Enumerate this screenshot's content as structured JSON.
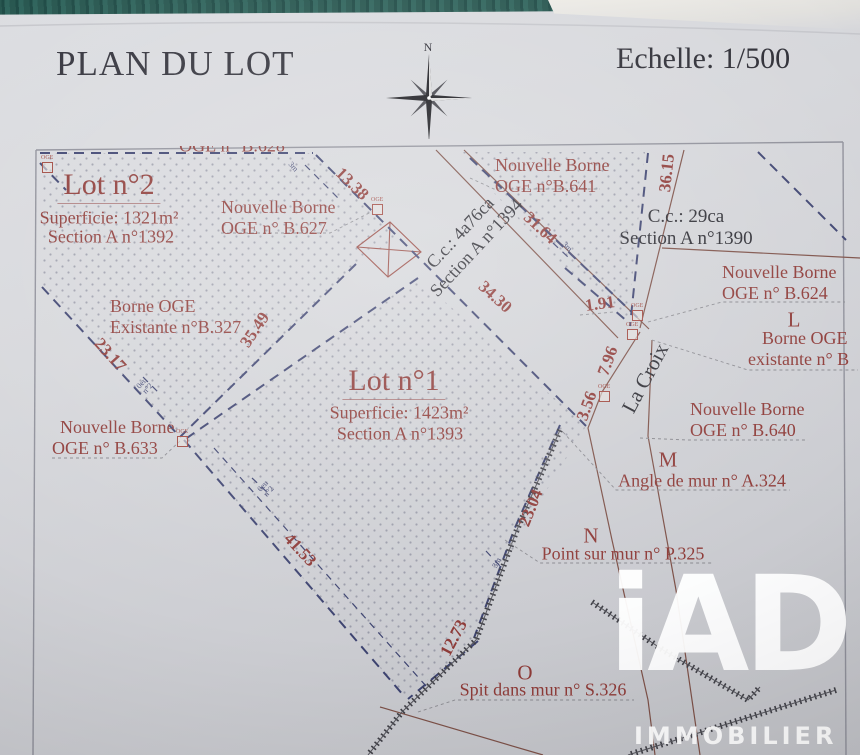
{
  "header": {
    "title": "PLAN DU LOT",
    "scale": "Echelle: 1/500",
    "compass_north": "N"
  },
  "lots": {
    "lot2": {
      "title": "Lot n°2",
      "area": "Superficie: 1321m²",
      "section": "Section A n°1392"
    },
    "lot1": {
      "title": "Lot n°1",
      "area": "Superficie: 1423m²",
      "section": "Section A n°1393"
    }
  },
  "parcels": {
    "cc_lane": {
      "line1": "C.c.: 4a76ca",
      "line2": "Section A n°1394"
    },
    "cc_right": {
      "line1": "C.c.: 29ca",
      "line2": "Section A n°1390"
    }
  },
  "bornes": {
    "b628_partial": "OGE n° B.628",
    "b627": {
      "line1": "Nouvelle Borne",
      "line2": "OGE n° B.627"
    },
    "b641": {
      "line1": "Nouvelle Borne",
      "line2": "OGE n°B.641"
    },
    "b624": {
      "line1": "Nouvelle Borne",
      "line2": "OGE n° B.624"
    },
    "b640": {
      "line1": "Nouvelle Borne",
      "line2": "OGE n° B.640"
    },
    "b633": {
      "line1": "Nouvelle Borne",
      "line2": "OGE n° B.633"
    },
    "b327": {
      "line1": "Borne OGE",
      "line2": "Existante n°B.327"
    },
    "existante_right": {
      "point": "L",
      "line1": "Borne OGE",
      "line2": "existante n° B"
    },
    "angle_mur": {
      "point": "M",
      "label": "Angle de mur n° A.324"
    },
    "point_mur": {
      "point": "N",
      "label": "Point sur mur n° P.325"
    },
    "spit_mur": {
      "point": "O",
      "label": "Spit dans mur n° S.326"
    }
  },
  "street": {
    "name": "La Croix"
  },
  "dimensions": {
    "d13_38": "13.38",
    "d31_64": "31.64",
    "d36_15": "36.15",
    "d34_30": "34.30",
    "d1_91": "1.91",
    "d7_96": "7.96",
    "d3_56": "3.56",
    "d23_04": "23.04",
    "d12_73": "12.73",
    "d41_53": "41.53",
    "d35_49": "35.49",
    "d23_17": "23.17"
  },
  "small_marks": {
    "m3": "3m",
    "tick_a": "0eu",
    "tick_b": "n°2",
    "oge": "OGE"
  },
  "logo": {
    "brand": "iAD",
    "subtitle": "IMMOBILIER"
  },
  "colors": {
    "label_red": "#8e3b38",
    "boundary_navy": "#3d4370",
    "line_brown": "#7d5148",
    "teal_strip": "#27564f"
  }
}
